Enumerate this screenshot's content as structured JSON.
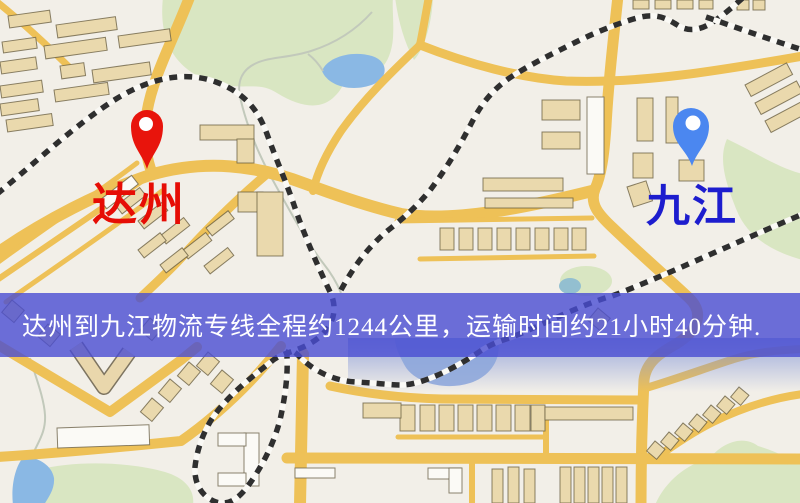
{
  "map": {
    "origin": {
      "name": "达州",
      "pin_color": "#e8140c",
      "label_color": "#e60d05"
    },
    "destination": {
      "name": "九江",
      "pin_color": "#4b87f0",
      "label_color": "#1d1dce"
    }
  },
  "banner": {
    "text": "达州到九江物流专线全程约1244公里，运输时间约21小时40分钟.",
    "background": "#4c4cd2",
    "text_color": "#ffffff"
  },
  "route": {
    "distance_km": "1244",
    "duration": "21小时40分钟"
  },
  "palette": {
    "map_background": "#f2efe8",
    "road": "#eec157",
    "park": "#d9e6c2",
    "water": "#8ab8e4",
    "railway_dark": "#2f2f2f",
    "building": "#ead9ad"
  }
}
